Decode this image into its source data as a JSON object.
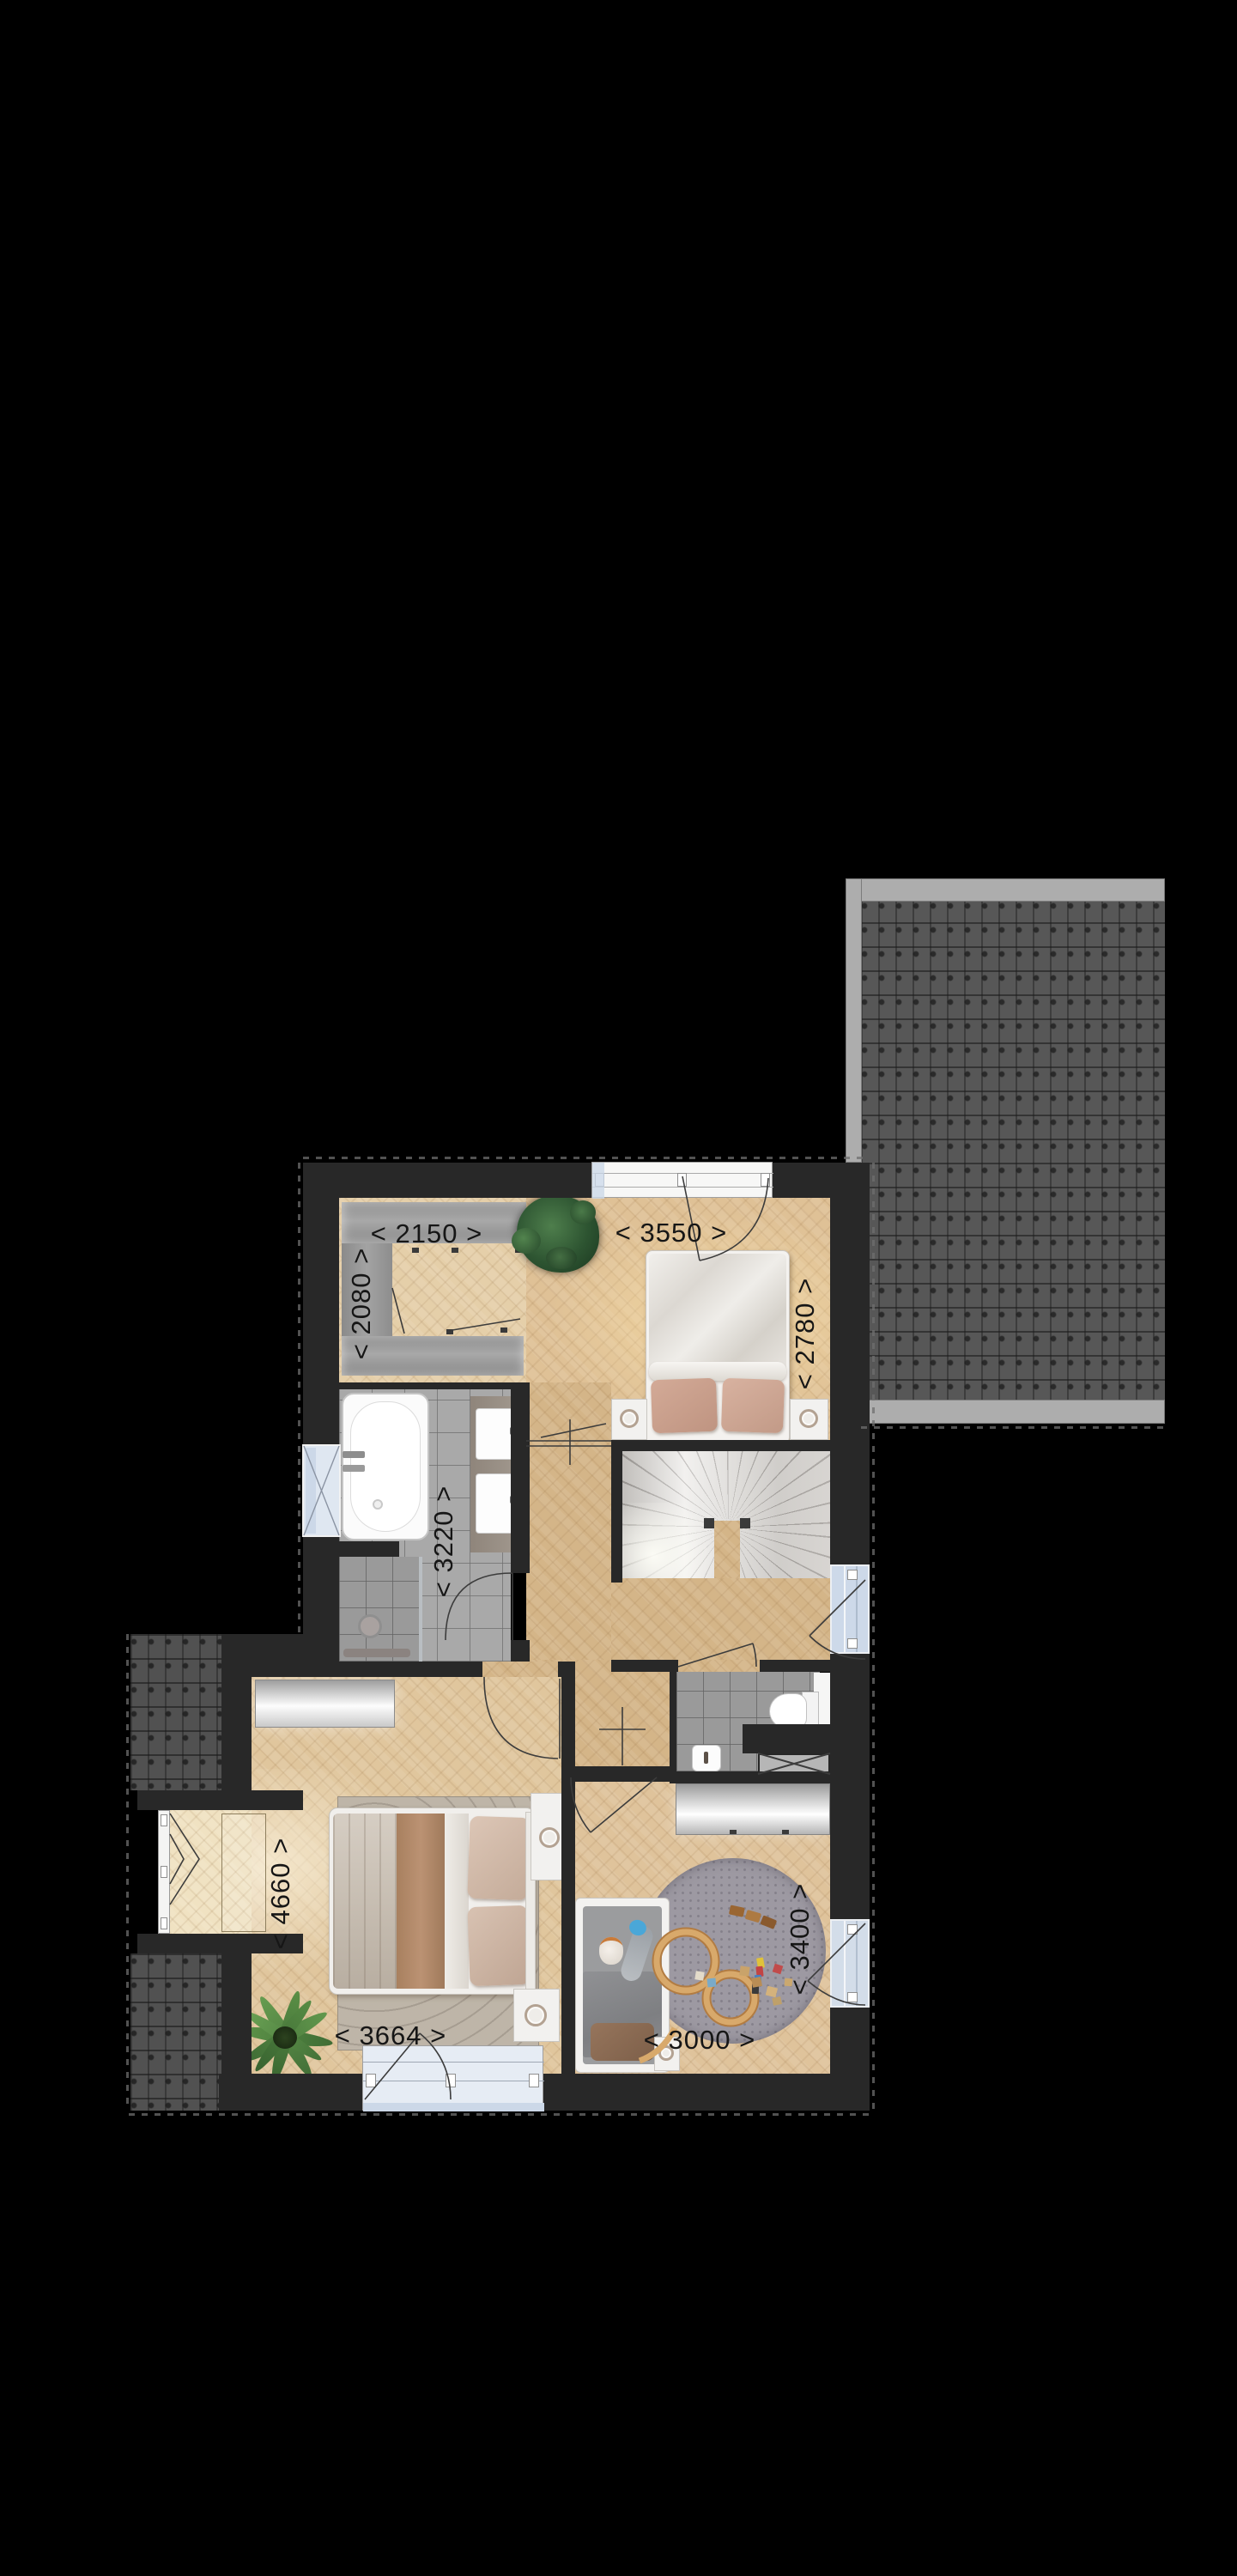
{
  "plan": {
    "type": "floor-plan-render",
    "dimension_labels": [
      {
        "id": "closet-width",
        "text": "< 2150 >",
        "orientation": "horizontal"
      },
      {
        "id": "bedroom2-width",
        "text": "< 3550 >",
        "orientation": "horizontal"
      },
      {
        "id": "closet-depth",
        "text": "< 2080 >",
        "orientation": "vertical"
      },
      {
        "id": "bedroom2-depth",
        "text": "< 2780 >",
        "orientation": "vertical"
      },
      {
        "id": "bathroom-depth",
        "text": "< 3220 >",
        "orientation": "vertical"
      },
      {
        "id": "bedroom1-depth",
        "text": "< 4660 >",
        "orientation": "vertical"
      },
      {
        "id": "bedroom1-width",
        "text": "< 3664 >",
        "orientation": "horizontal"
      },
      {
        "id": "kidsroom-width",
        "text": "< 3000 >",
        "orientation": "horizontal"
      },
      {
        "id": "kidsroom-depth",
        "text": "< 3400 >",
        "orientation": "vertical"
      }
    ],
    "colors": {
      "background": "#000000",
      "wall": "#282828",
      "roof_tile": "#575757",
      "roof_gutter": "#adadad",
      "wood_floor": "#d9bc92",
      "bathroom_tile": "#a9a9a9",
      "window_glass": "#ccd8e8",
      "stairs": "#e9e7e4",
      "rug_kids": "#9d99a2",
      "rug_bedroom": "#bdb4a7",
      "plant_green": "#3d6b3d",
      "toy_track": "#d3a265"
    }
  }
}
